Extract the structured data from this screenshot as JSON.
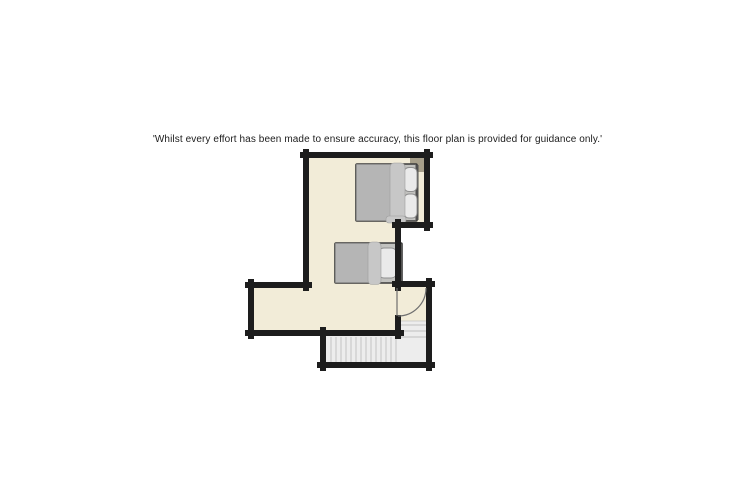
{
  "page": {
    "background_color": "#ffffff"
  },
  "disclaimer": {
    "text": "'Whilst every effort has been made to ensure accuracy, this floor plan is provided for guidance only.'"
  },
  "floorplan": {
    "description": "Upper-floor plan with one double bedroom area, a single bed, a hinged door vestibule and a staircase",
    "colors": {
      "page_bg": "#ffffff",
      "wall": "#1d1d1d",
      "floor": "#f2ecd8",
      "stairs": "#ededed",
      "stair_line": "#cfcfcf",
      "stair_edge": "#c4c4c4",
      "bed_base": "#c2c2bf",
      "bed_duvet": "#b5b5b5",
      "bed_fold": "#c7c7c7",
      "pillow": "#eaeaea",
      "bed_frame_stroke": "#3a3a3a",
      "headboard": "#4f4f4f",
      "corner_fixture": "#a79f8a",
      "door_line": "#6f6f6f"
    },
    "elements": [
      {
        "name": "double-bed",
        "kind": "furniture"
      },
      {
        "name": "single-bed",
        "kind": "furniture"
      },
      {
        "name": "door-swing",
        "kind": "door"
      },
      {
        "name": "staircase",
        "kind": "stairs"
      },
      {
        "name": "corner-fixture",
        "kind": "fixture"
      }
    ]
  }
}
